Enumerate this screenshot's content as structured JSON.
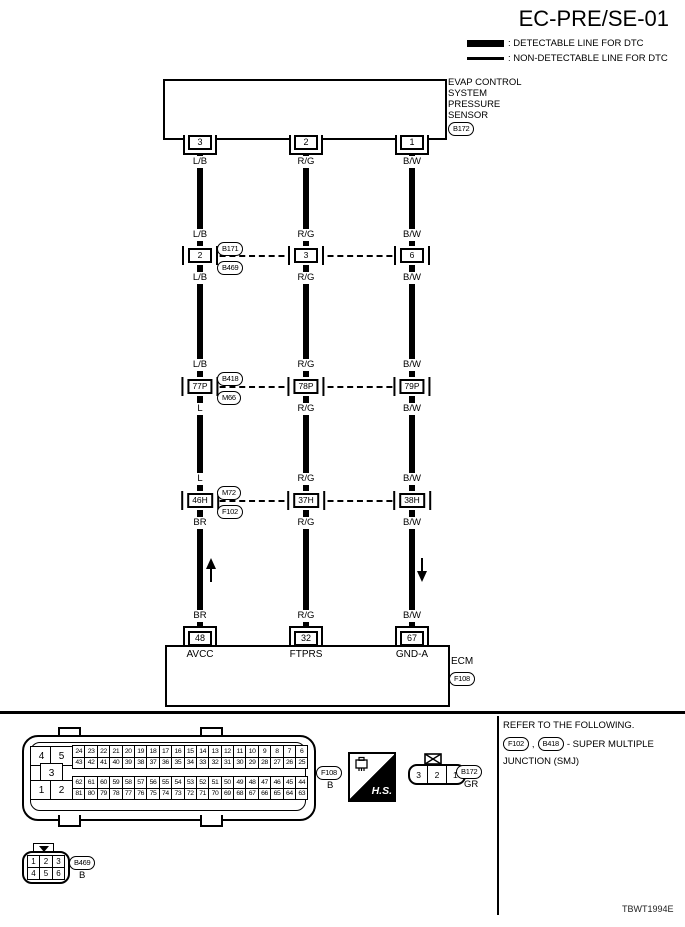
{
  "title": "EC-PRE/SE-01",
  "legend": {
    "detectable_label": ": DETECTABLE LINE FOR DTC",
    "non_detectable_label": ": NON-DETECTABLE LINE FOR DTC"
  },
  "sensor": {
    "name_lines": [
      "EVAP CONTROL",
      "SYSTEM",
      "PRESSURE",
      "SENSOR"
    ],
    "connector_id": "B172"
  },
  "columns": [
    {
      "sensor_pin": "3",
      "wire_top": "L/B",
      "rowA_above": "L/B",
      "rowA_pin": "2",
      "rowA_below": "L/B",
      "rowB_above": "L/B",
      "rowB_pin": "77P",
      "rowB_below": "L",
      "rowC_above": "L",
      "rowC_pin": "46H",
      "rowC_below": "BR",
      "wire_bottom": "BR",
      "ecm_pin": "48",
      "ecm_pin_name": "AVCC"
    },
    {
      "sensor_pin": "2",
      "wire_top": "R/G",
      "rowA_above": "R/G",
      "rowA_pin": "3",
      "rowA_below": "R/G",
      "rowB_above": "R/G",
      "rowB_pin": "78P",
      "rowB_below": "R/G",
      "rowC_above": "R/G",
      "rowC_pin": "37H",
      "rowC_below": "R/G",
      "wire_bottom": "R/G",
      "ecm_pin": "32",
      "ecm_pin_name": "FTPRS"
    },
    {
      "sensor_pin": "1",
      "wire_top": "B/W",
      "rowA_above": "B/W",
      "rowA_pin": "6",
      "rowA_below": "B/W",
      "rowB_above": "B/W",
      "rowB_pin": "79P",
      "rowB_below": "B/W",
      "rowC_above": "B/W",
      "rowC_pin": "38H",
      "rowC_below": "B/W",
      "wire_bottom": "B/W",
      "ecm_pin": "67",
      "ecm_pin_name": "GND-A"
    }
  ],
  "junctions": [
    {
      "top_id": "B171",
      "bottom_id": "B469"
    },
    {
      "top_id": "B418",
      "bottom_id": "M66"
    },
    {
      "top_id": "M72",
      "bottom_id": "F102"
    }
  ],
  "ecm": {
    "name": "ECM",
    "connector_id": "F108"
  },
  "footer": {
    "big_connector": {
      "left_pins": [
        "4",
        "5",
        "3",
        "1",
        "2"
      ],
      "grid_rows": [
        [
          "24",
          "23",
          "22",
          "21",
          "20",
          "19",
          "18",
          "17",
          "16",
          "15",
          "14",
          "13",
          "12",
          "11",
          "10",
          "9",
          "8",
          "7",
          "6"
        ],
        [
          "43",
          "42",
          "41",
          "40",
          "39",
          "38",
          "37",
          "36",
          "35",
          "34",
          "33",
          "32",
          "31",
          "30",
          "29",
          "28",
          "27",
          "26",
          "25"
        ],
        [
          "62",
          "61",
          "60",
          "59",
          "58",
          "57",
          "56",
          "55",
          "54",
          "53",
          "52",
          "51",
          "50",
          "49",
          "48",
          "47",
          "46",
          "45",
          "44"
        ],
        [
          "81",
          "80",
          "79",
          "78",
          "77",
          "76",
          "75",
          "74",
          "73",
          "72",
          "71",
          "70",
          "69",
          "68",
          "67",
          "66",
          "65",
          "64",
          "63"
        ]
      ],
      "connector_id": "F108",
      "connector_color": "B"
    },
    "hs_badge": "H.S.",
    "connector_3pin": {
      "pins": [
        "3",
        "2",
        "1"
      ],
      "connector_id": "B172",
      "connector_color": "GR"
    },
    "connector_6pin": {
      "row1": [
        "1",
        "2",
        "3"
      ],
      "row2": [
        "4",
        "5",
        "6"
      ],
      "connector_id": "B469",
      "connector_color": "B"
    },
    "note": {
      "line1": "REFER TO THE FOLLOWING.",
      "ref1": "F102",
      "ref_separator": ",",
      "ref2": "B418",
      "line2_text": "- SUPER MULTIPLE",
      "line3": "JUNCTION (SMJ)"
    },
    "figure_code": "TBWT1994E"
  }
}
